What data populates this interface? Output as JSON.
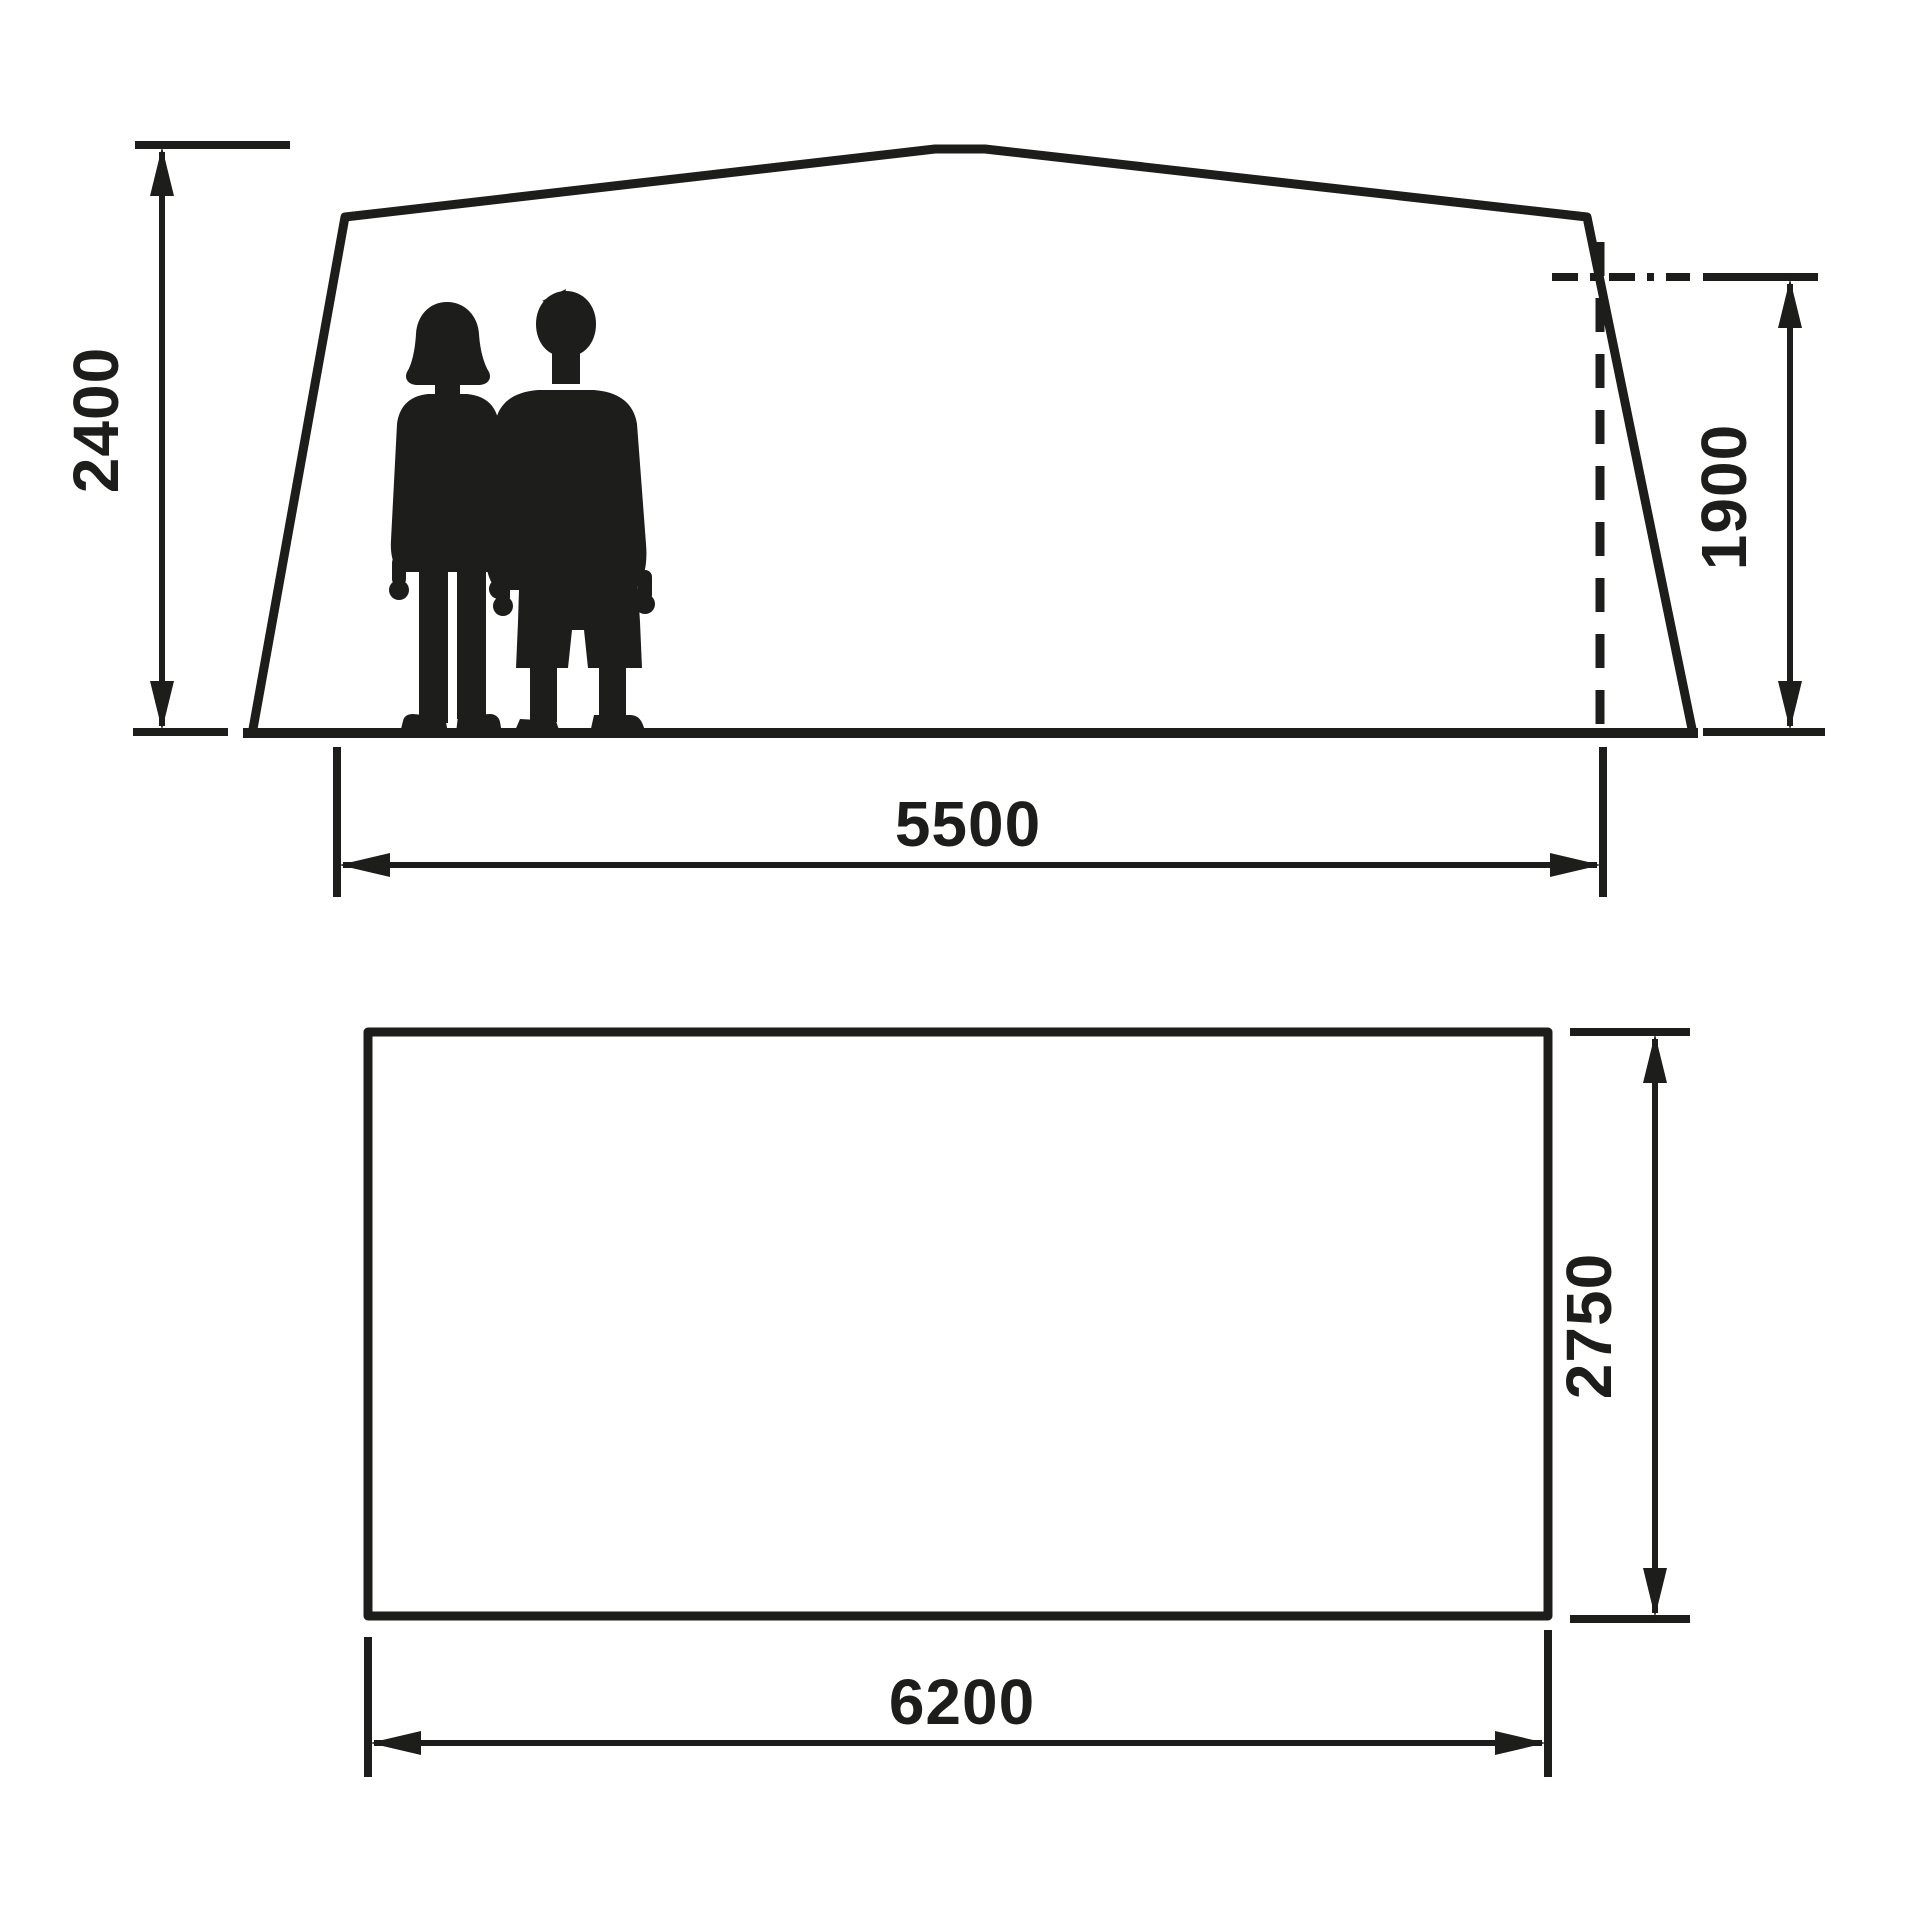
{
  "diagram": {
    "description": "tent-dimension-drawing",
    "background_color": "#ffffff",
    "line_color": "#1d1d1b",
    "side_view": {
      "name": "side-elevation",
      "dim_height_left": "2400",
      "dim_height_right": "1900",
      "dim_width": "5500",
      "figures": [
        "woman-silhouette",
        "man-silhouette"
      ]
    },
    "plan_view": {
      "name": "floor-plan",
      "dim_width": "6200",
      "dim_depth": "2750"
    }
  }
}
